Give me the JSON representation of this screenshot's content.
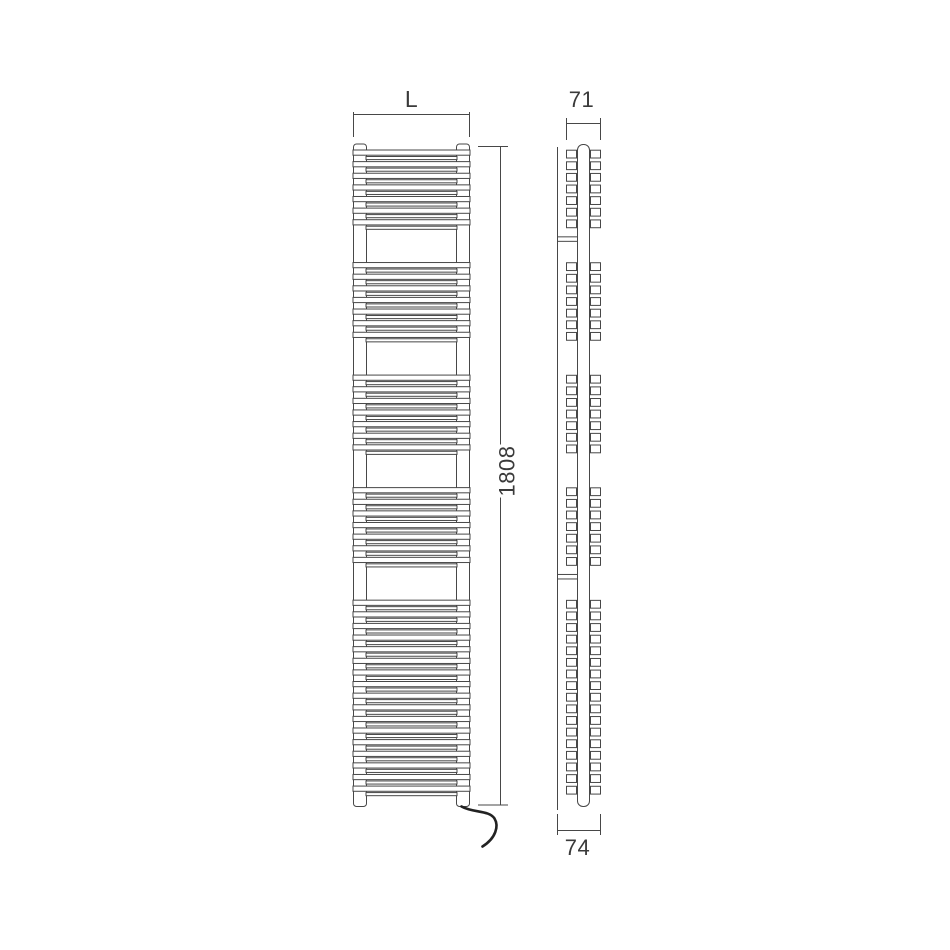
{
  "drawing": {
    "type": "technical-drawing",
    "subject": "electric towel radiator - front and side elevation",
    "background": "#ffffff",
    "line_color": "#474747",
    "cable_color": "#222222",
    "text_color": "#3a3a3a",
    "front_view": {
      "rung_groups": [
        7,
        7,
        7,
        7,
        17
      ],
      "width_dim_label": "L",
      "height_dim_label": "1808"
    },
    "side_view": {
      "rung_groups": [
        7,
        7,
        7,
        7,
        17
      ],
      "top_dim_label": "71",
      "bottom_dim_label": "74",
      "bracket_gap_indices": [
        0,
        3
      ]
    },
    "icons": {
      "cable": "power-cable"
    }
  }
}
